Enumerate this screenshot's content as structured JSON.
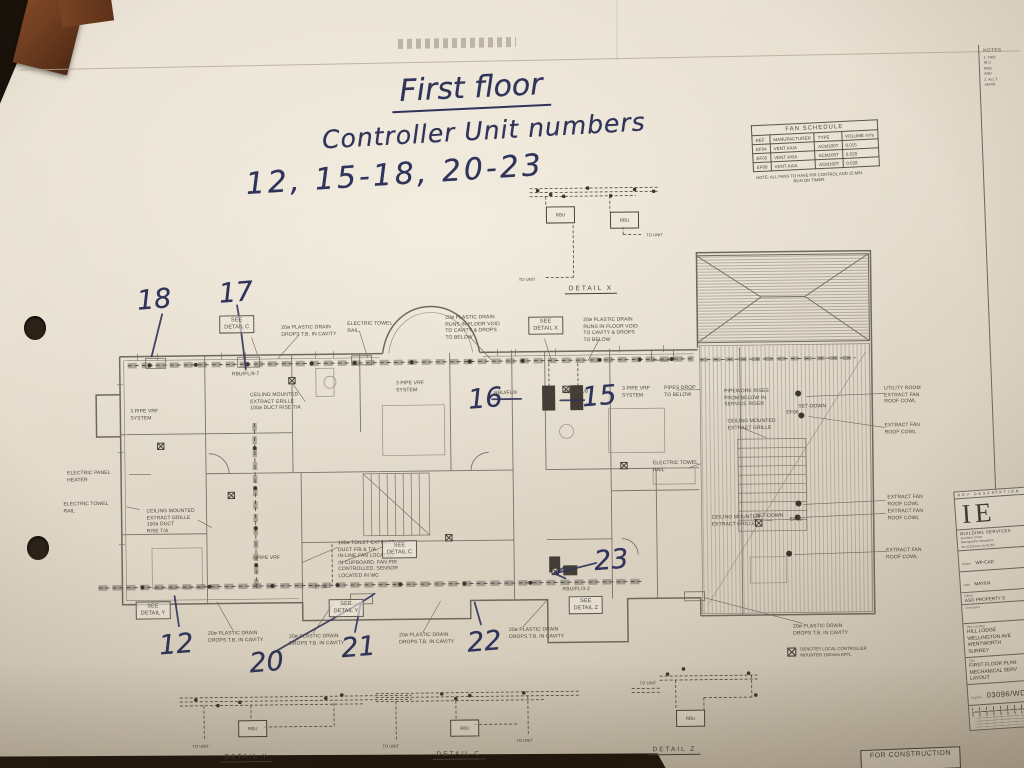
{
  "handwritten": {
    "line1": "First floor",
    "line2": "Controller Unit numbers",
    "line3": "12, 15-18, 20-23",
    "plan_numbers": [
      {
        "n": "18",
        "x": 138,
        "y": 280
      },
      {
        "n": "17",
        "x": 220,
        "y": 274
      },
      {
        "n": "16",
        "x": 468,
        "y": 383
      },
      {
        "n": "15",
        "x": 582,
        "y": 382
      },
      {
        "n": "23",
        "x": 592,
        "y": 546
      },
      {
        "n": "12",
        "x": 156,
        "y": 625
      },
      {
        "n": "20",
        "x": 246,
        "y": 644
      },
      {
        "n": "21",
        "x": 338,
        "y": 630
      },
      {
        "n": "22",
        "x": 464,
        "y": 626
      }
    ]
  },
  "fan_schedule": {
    "title": "FAN SCHEDULE",
    "columns": [
      "REF",
      "MANUFACTURER",
      "TYPE",
      "VOLUME m³/s"
    ],
    "rows": [
      [
        "EF04",
        "VENT AXIA",
        "ACM100T",
        "0.015"
      ],
      [
        "EF05",
        "VENT AXIA",
        "ACM100T",
        "0.028"
      ],
      [
        "EF06",
        "VENT AXIA",
        "ACM100T",
        "0.028"
      ]
    ],
    "note": "NOTE: ALL FANS TO HAVE PIR CONTROL AND 15 MIN RUN ON TIMER."
  },
  "notes_panel": {
    "title": "NOTES",
    "lines": [
      "1. THIS",
      "IN C",
      "PRO",
      "AND",
      "2. ALL T",
      "ADVIS"
    ]
  },
  "details": {
    "x": {
      "label": "DETAIL X",
      "rbu": "RBU",
      "rbu2": "RBU",
      "to_unit": "TO UNIT",
      "to_unit2": "TO UNIT"
    },
    "y": {
      "label": "DETAIL Y",
      "rbu": "RBU",
      "to_unit": "TO UNIT"
    },
    "c": {
      "label": "DETAIL C",
      "rbu": "RBU",
      "to_unit": "TO UNIT",
      "to_unit2": "TO UNIT"
    },
    "z": {
      "label": "DETAIL Z",
      "rbu": "RBU",
      "to_unit": "TO UNIT"
    }
  },
  "plan": {
    "labels": [
      {
        "text": "SEE\nDETAIL C",
        "x": 220,
        "y": 312,
        "boxed": true
      },
      {
        "text": "20ø PLASTIC DRAIN\nDROPS T.B. IN CAVITY",
        "x": 282,
        "y": 322
      },
      {
        "text": "ELECTRIC TOWEL\nRAIL",
        "x": 348,
        "y": 319
      },
      {
        "text": "20ø PLASTIC DRAIN\nRUNS IN FLOOR VOID\nTO CAVITY & DROPS\nTO BELOW",
        "x": 446,
        "y": 314
      },
      {
        "text": "SEE\nDETAIL X",
        "x": 529,
        "y": 317,
        "boxed": true
      },
      {
        "text": "20ø PLASTIC DRAIN\nRUNS IN FLOOR VOID\nTO CAVITY & DROPS\nTO BELOW",
        "x": 584,
        "y": 318
      },
      {
        "text": "3 PIPE VRF\nSYSTEM",
        "x": 396,
        "y": 379
      },
      {
        "text": "3 PIPE VRF\nSYSTEM",
        "x": 622,
        "y": 387
      },
      {
        "text": "PIPES DROP\nTO BELOW",
        "x": 664,
        "y": 387
      },
      {
        "text": "PIPEWORK RISES\nFROM BELOW IN\nSERVICE RISER",
        "x": 724,
        "y": 391
      },
      {
        "text": "UTILITY ROOM\nEXTRACT FAN\nROOF COWL",
        "x": 884,
        "y": 390
      },
      {
        "text": "EXTRACT FAN\nROOF COWL",
        "x": 884,
        "y": 427
      },
      {
        "text": "CEILING MOUNTED\nEXTRACT GRILLE\n100ø DUCT RISE T/A",
        "x": 250,
        "y": 389
      },
      {
        "text": "CEILING MOUNTED\nEXTRACT GRILLE",
        "x": 727,
        "y": 421
      },
      {
        "text": "3 PIPE VRF\nSYSTEM",
        "x": 130,
        "y": 404
      },
      {
        "text": "ELECTRIC PANEL\nHEATER",
        "x": 66,
        "y": 465
      },
      {
        "text": "ELECTRIC TOWEL\nRAIL",
        "x": 62,
        "y": 496
      },
      {
        "text": "ELECTRIC TOWEL\nRAIL",
        "x": 652,
        "y": 462
      },
      {
        "text": "CEILING MOUNTED\nEXTRACT GRILLE\n100ø DUCT\nRISE T/A",
        "x": 145,
        "y": 504
      },
      {
        "text": "CEILING MOUNTED\nEXTRACT GRILLE",
        "x": 710,
        "y": 517
      },
      {
        "text": "EXTRACT FAN\nROOF COWL",
        "x": 886,
        "y": 499
      },
      {
        "text": "EXTRACT FAN\nROOF COWL",
        "x": 886,
        "y": 513
      },
      {
        "text": "EXTRACT FAN\nROOF COWL",
        "x": 884,
        "y": 552
      },
      {
        "text": "100ø TOILET EXTRACT\nDUCT F/B & T/A.\nIN-LINE FAN LOCATED\nIN CUPBOARD. FAN PIR\nCONTROLLED. SENSOR\nLOCATED IN WC",
        "x": 336,
        "y": 538
      },
      {
        "text": "3 PIPE VRF",
        "x": 250,
        "y": 552
      },
      {
        "text": "SEE\nDETAIL C",
        "x": 380,
        "y": 539,
        "boxed": true
      },
      {
        "text": "SEE\nDETAIL Y",
        "x": 133,
        "y": 597,
        "boxed": true
      },
      {
        "text": "SEE\nDETAIL Y",
        "x": 326,
        "y": 597,
        "boxed": true
      },
      {
        "text": "SEE\nDETAIL Z",
        "x": 566,
        "y": 597,
        "boxed": true
      },
      {
        "text": "20ø PLASTIC DRAIN\nDROPS T.B. IN CAVITY",
        "x": 205,
        "y": 627
      },
      {
        "text": "20ø PLASTIC DRAIN\nDROPS T.B. IN CAVITY",
        "x": 286,
        "y": 631
      },
      {
        "text": "20ø PLASTIC DRAIN\nDROPS T.B. IN CAVITY",
        "x": 396,
        "y": 631
      },
      {
        "text": "20ø PLASTIC DRAIN\nDROPS T.B. IN CAVITY",
        "x": 506,
        "y": 627
      },
      {
        "text": "20ø PLASTIC DRAIN\nDROPS T.B. IN CAVITY",
        "x": 790,
        "y": 627
      },
      {
        "text": "SET-DOWN",
        "x": 798,
        "y": 407
      },
      {
        "text": "SET-DOWN",
        "x": 754,
        "y": 516
      },
      {
        "text": "EF04",
        "x": 312,
        "y": 582
      },
      {
        "text": "EF05",
        "x": 788,
        "y": 520
      },
      {
        "text": "EF06",
        "x": 786,
        "y": 413
      },
      {
        "text": "RBU/FL/9-7",
        "x": 232,
        "y": 368
      },
      {
        "text": "RBU/FL/9",
        "x": 494,
        "y": 390
      },
      {
        "text": "RBU/FL/9",
        "x": 565,
        "y": 390
      },
      {
        "text": "RBU/FL/3-2",
        "x": 560,
        "y": 587
      }
    ]
  },
  "legend": {
    "text": "DENOTES LOCAL CONTROLLER\nMOUNTED 1500mm AFFL"
  },
  "title_block": {
    "rev_header": "REV   DESCRIPTION",
    "logo": "IE",
    "firm": "BUILDING SERVICES",
    "address": "Southern Cross\nBasingstoke Hampshire\nTel 01256   Fax No 01256",
    "drawn_label": "drawn",
    "drawn": "WP-CAD",
    "date_label": "date",
    "date": "MAY/04",
    "client_label": "Client",
    "client": "ASO PROPERTY S",
    "contractor_label": "Contractor",
    "site_label": "Site Location",
    "site": "HILL LODGE\nWELLINGTON AVE\nWENTWORTH\nSURREY",
    "title_label": "Title",
    "title": "FIRST FLOOR PLAN\nMECHANICAL SERV\nLAYOUT",
    "drg_label": "Drg No.",
    "drg_no": "03096/WD/",
    "stamp": "FOR CONSTRUCTION"
  }
}
